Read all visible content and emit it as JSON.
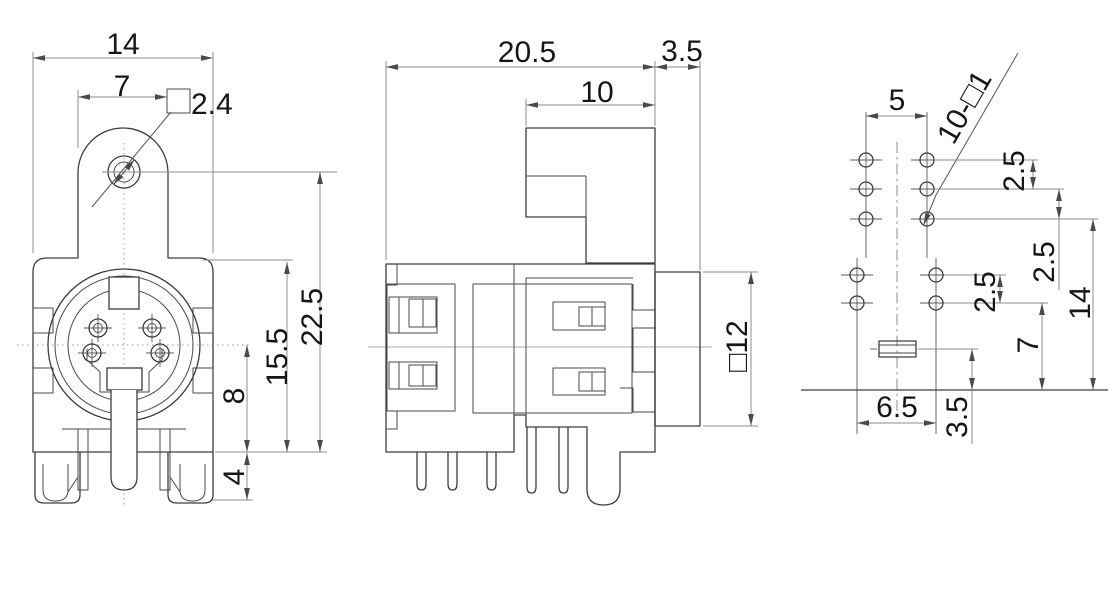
{
  "drawing": {
    "front_view": {
      "labels": {
        "overall_width": "14",
        "tab_width": "7",
        "mount_hole_square": "2.4",
        "center_to_base": "8",
        "leg_height": "4",
        "body_height": "15.5",
        "hole_to_base": "22.5"
      }
    },
    "side_view": {
      "labels": {
        "overall_depth": "20.5",
        "barrel_depth": "3.5",
        "tab_depth": "10",
        "barrel_square": "□12"
      }
    },
    "footprint_view": {
      "labels": {
        "pin_pitch": "5",
        "hole_callout": "10-□1",
        "row_pitch_a": "2.5",
        "row_pitch_b": "2.5",
        "row_pitch_c": "2.5",
        "row3_to_base": "14",
        "row5_to_base": "7",
        "slot_to_base": "3.5",
        "bottom_pitch": "6.5"
      }
    }
  }
}
